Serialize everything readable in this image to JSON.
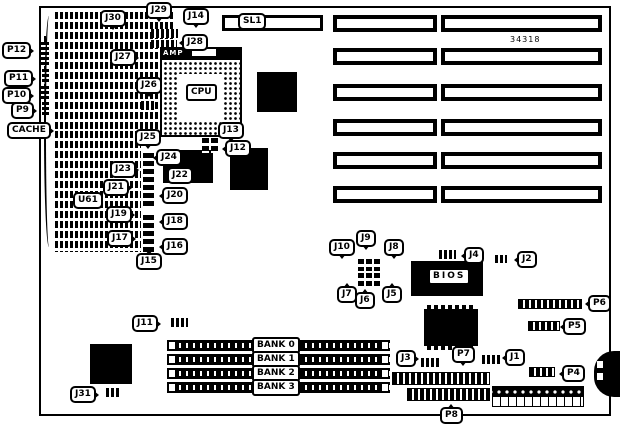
{
  "board": {
    "part_number": "34318"
  },
  "chips": {
    "cpu": "CPU",
    "amp": "AMP",
    "bios": "BIOS",
    "cache": "CACHE",
    "u61": "U61",
    "sl1": "SL1"
  },
  "banks": [
    "BANK 0",
    "BANK 1",
    "BANK 2",
    "BANK 3"
  ],
  "labels": {
    "p12": "P12",
    "p11": "P11",
    "p10": "P10",
    "p9": "P9",
    "j30": "J30",
    "j29": "J29",
    "j28": "J28",
    "j27": "J27",
    "j26": "J26",
    "j25": "J25",
    "j24": "J24",
    "j23": "J23",
    "j22": "J22",
    "j21": "J21",
    "j20": "J20",
    "j19": "J19",
    "j18": "J18",
    "j17": "J17",
    "j16": "J16",
    "j15": "J15",
    "j14": "J14",
    "j13": "J13",
    "j12": "J12",
    "j11": "J11",
    "j10": "J10",
    "j9": "J9",
    "j8": "J8",
    "j7": "J7",
    "j6": "J6",
    "j5": "J5",
    "j4": "J4",
    "j3": "J3",
    "j2": "J2",
    "j1": "J1",
    "j31": "J31",
    "p8": "P8",
    "p7": "P7",
    "p6": "P6",
    "p5": "P5",
    "p4": "P4"
  }
}
